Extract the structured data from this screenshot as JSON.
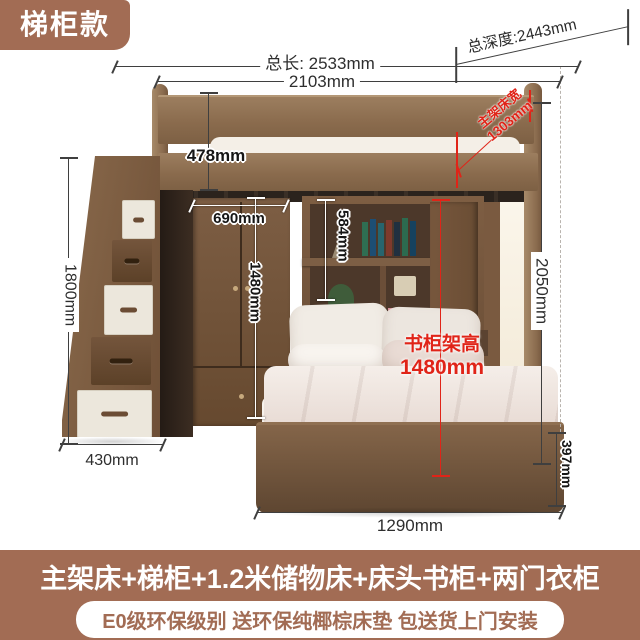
{
  "badge": {
    "label": "梯柜款"
  },
  "dimensions": {
    "total_length": "总长: 2533mm",
    "upper_length": "2103mm",
    "total_depth": "总深度:2443mm",
    "rail_height": "478mm",
    "wardrobe_width": "690mm",
    "wardrobe_height": "1480mm",
    "bookshelf_height": "584mm",
    "main_bed_width_label": "主架床宽",
    "main_bed_width_value": "1303mm",
    "overall_height": "2050mm",
    "bookcase_frame_label": "书柜架高",
    "bookcase_frame_value": "1480mm",
    "base_height": "397mm",
    "stair_depth": "430mm",
    "bed_length": "1290mm",
    "stair_height": "1800mm"
  },
  "banner": {
    "title": "主架床+梯柜+1.2米储物床+床头书柜+两门衣柜",
    "subtitle": "E0级环保级别 送环保纯椰棕床垫 包送货上门安装"
  },
  "colors": {
    "brown": "#a26c54",
    "red": "#e02418"
  }
}
